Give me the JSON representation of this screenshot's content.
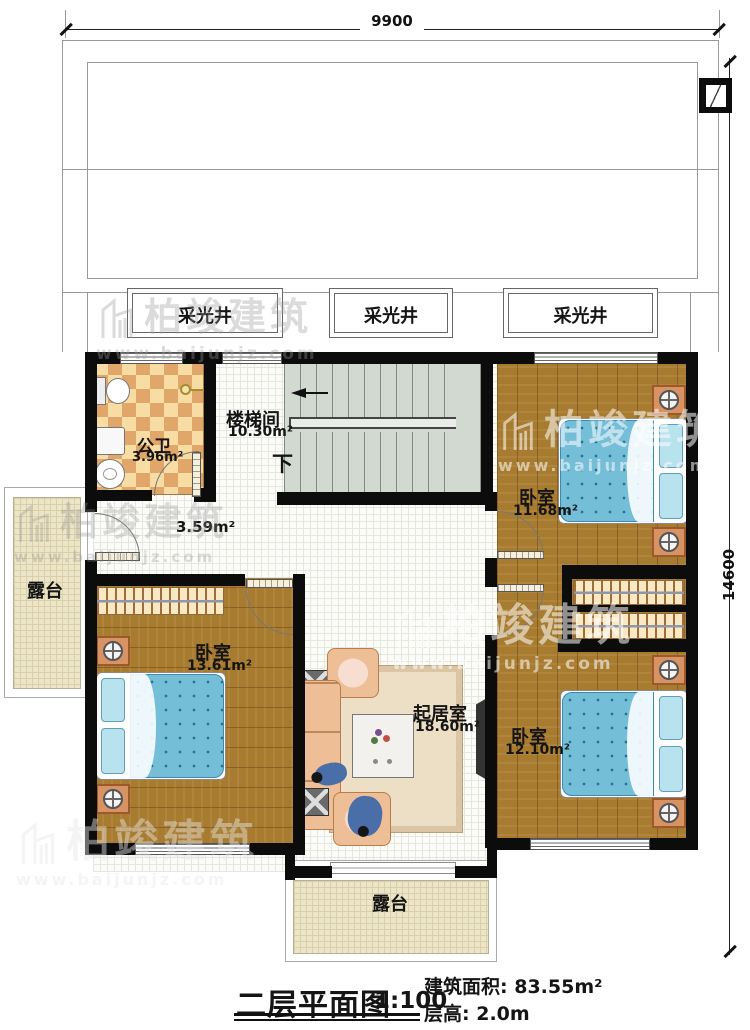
{
  "title_block": {
    "plan_title": "二层平面图",
    "scale": "1:100",
    "area_label": "建筑面积:",
    "area_value": "83.55m²",
    "floor_height_label": "层高:",
    "floor_height_value": "2.0m"
  },
  "dimensions": {
    "width_mm": "9900",
    "height_mm": "14600"
  },
  "watermark": {
    "brand": "柏竣建筑",
    "url": "www.baijunjz.com"
  },
  "rooms": {
    "light_well_1": "采光井",
    "light_well_2": "采光井",
    "light_well_3": "采光井",
    "stair": {
      "name": "楼梯间",
      "area": "10.30m²",
      "down_label": "下"
    },
    "bathroom": {
      "name": "公卫",
      "area": "3.96m²"
    },
    "hallway": {
      "area": "3.59m²"
    },
    "bedroom_top_right": {
      "name": "卧室",
      "area": "11.68m²"
    },
    "bedroom_left": {
      "name": "卧室",
      "area": "13.61m²"
    },
    "bedroom_bottom_right": {
      "name": "卧室",
      "area": "12.10m²"
    },
    "living_room": {
      "name": "起居室",
      "area": "18.60m²"
    },
    "terrace_left": {
      "name": "露台"
    },
    "terrace_bottom": {
      "name": "露台"
    }
  },
  "colors": {
    "wall": "#0c0c0c",
    "wood_floor": "#a87c30",
    "bathroom_tile_light": "#f7dca3",
    "bathroom_tile_dark": "#e0a66a",
    "stair_fill": "#d2d9d1",
    "terrace_fill": "#ece5c8",
    "bed_blue": "#74bed8",
    "sofa_tan": "#eebf96"
  }
}
